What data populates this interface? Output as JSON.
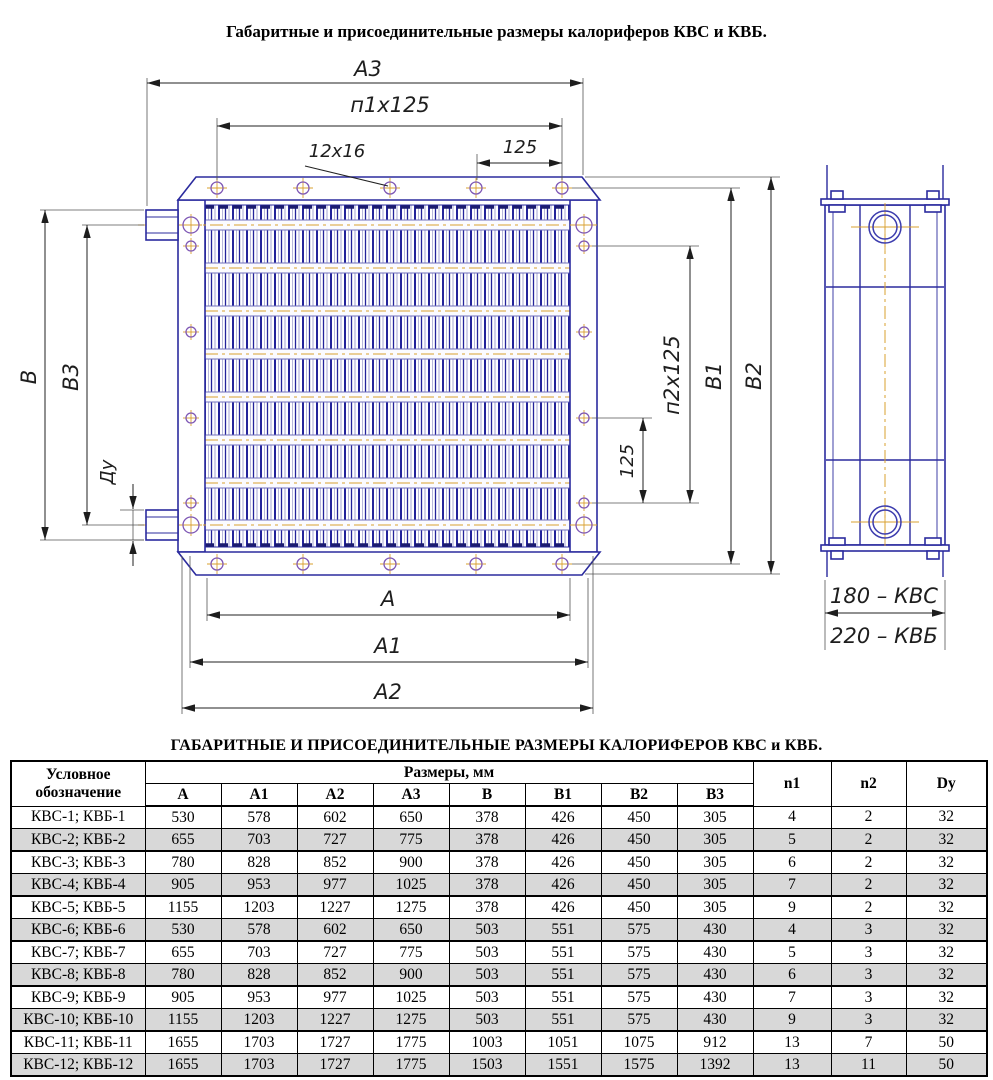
{
  "page": {
    "title": "Габаритные и присоединительные размеры калориферов КВС и КВБ."
  },
  "drawing": {
    "labels": {
      "a3": "А3",
      "n1x125": "п1х125",
      "holes_callout": "12х16",
      "pitch_top": "125",
      "a": "А",
      "a1": "А1",
      "a2": "А2",
      "b": "В",
      "b3": "В3",
      "du": "Ду",
      "pitch_right": "125",
      "n2x125": "п2х125",
      "b1": "В1",
      "b2": "В2",
      "depth_kvs": "180 – КВС",
      "depth_kvb": "220 – КВБ"
    },
    "palette": {
      "outline_blue": "#2b2b9e",
      "fin_light": "#9b9bd0",
      "centerline_orange": "#d9a02f",
      "hole_purple": "#7e57b5",
      "dimension_gray": "#222222",
      "row_shading": "#d8d8d8"
    }
  },
  "table": {
    "title": "ГАБАРИТНЫЕ И ПРИСОЕДИНИТЕЛЬНЫЕ РАЗМЕРЫ КАЛОРИФЕРОВ КВС и КВБ.",
    "designation_header": "Условное обозначение",
    "sizes_header": "Размеры, мм",
    "size_cols": [
      "А",
      "А1",
      "А2",
      "А3",
      "В",
      "В1",
      "В2",
      "В3"
    ],
    "extra_cols": [
      "n1",
      "n2",
      "Dy"
    ],
    "rows": [
      {
        "label": "КВС-1; КВБ-1",
        "values": [
          "530",
          "578",
          "602",
          "650",
          "378",
          "426",
          "450",
          "305",
          "4",
          "2",
          "32"
        ]
      },
      {
        "label": "КВС-2; КВБ-2",
        "values": [
          "655",
          "703",
          "727",
          "775",
          "378",
          "426",
          "450",
          "305",
          "5",
          "2",
          "32"
        ]
      },
      {
        "label": "КВС-3; КВБ-3",
        "values": [
          "780",
          "828",
          "852",
          "900",
          "378",
          "426",
          "450",
          "305",
          "6",
          "2",
          "32"
        ]
      },
      {
        "label": "КВС-4; КВБ-4",
        "values": [
          "905",
          "953",
          "977",
          "1025",
          "378",
          "426",
          "450",
          "305",
          "7",
          "2",
          "32"
        ]
      },
      {
        "label": "КВС-5; КВБ-5",
        "values": [
          "1155",
          "1203",
          "1227",
          "1275",
          "378",
          "426",
          "450",
          "305",
          "9",
          "2",
          "32"
        ]
      },
      {
        "label": "КВС-6; КВБ-6",
        "values": [
          "530",
          "578",
          "602",
          "650",
          "503",
          "551",
          "575",
          "430",
          "4",
          "3",
          "32"
        ]
      },
      {
        "label": "КВС-7; КВБ-7",
        "values": [
          "655",
          "703",
          "727",
          "775",
          "503",
          "551",
          "575",
          "430",
          "5",
          "3",
          "32"
        ]
      },
      {
        "label": "КВС-8; КВБ-8",
        "values": [
          "780",
          "828",
          "852",
          "900",
          "503",
          "551",
          "575",
          "430",
          "6",
          "3",
          "32"
        ]
      },
      {
        "label": "КВС-9; КВБ-9",
        "values": [
          "905",
          "953",
          "977",
          "1025",
          "503",
          "551",
          "575",
          "430",
          "7",
          "3",
          "32"
        ]
      },
      {
        "label": "КВС-10; КВБ-10",
        "values": [
          "1155",
          "1203",
          "1227",
          "1275",
          "503",
          "551",
          "575",
          "430",
          "9",
          "3",
          "32"
        ]
      },
      {
        "label": "КВС-11; КВБ-11",
        "values": [
          "1655",
          "1703",
          "1727",
          "1775",
          "1003",
          "1051",
          "1075",
          "912",
          "13",
          "7",
          "50"
        ]
      },
      {
        "label": "КВС-12; КВБ-12",
        "values": [
          "1655",
          "1703",
          "1727",
          "1775",
          "1503",
          "1551",
          "1575",
          "1392",
          "13",
          "11",
          "50"
        ]
      }
    ]
  }
}
